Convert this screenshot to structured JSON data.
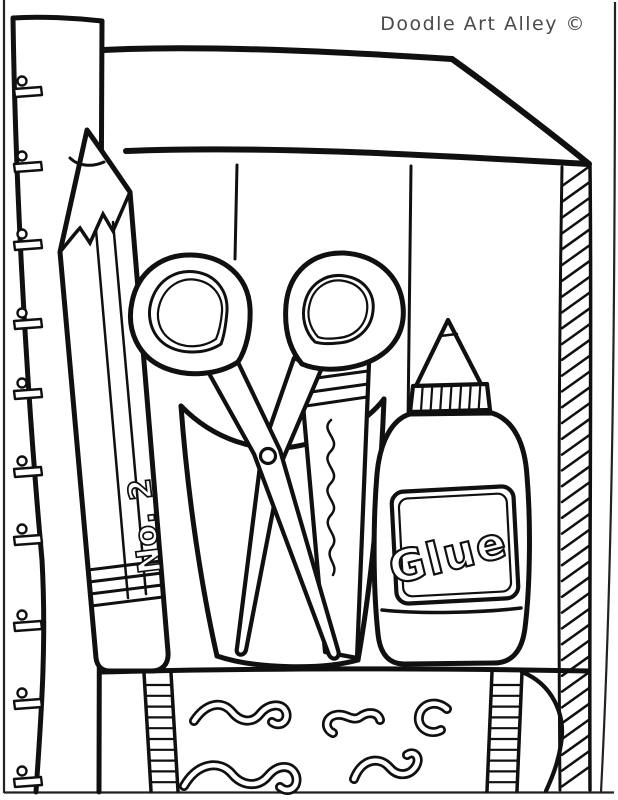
{
  "credit": {
    "text": "Doodle Art Alley ©",
    "color": "#4a4a4a"
  },
  "labels": {
    "pencil": "No. 2",
    "glue": "Glue"
  },
  "palette": {
    "line": "#101010",
    "background": "#ffffff"
  },
  "scene": {
    "description": "black-and-white coloring page of school supplies",
    "objects": [
      "ruler",
      "supply box",
      "pencil",
      "scissors",
      "pencil cup",
      "marker",
      "glue bottle",
      "crayon"
    ]
  }
}
